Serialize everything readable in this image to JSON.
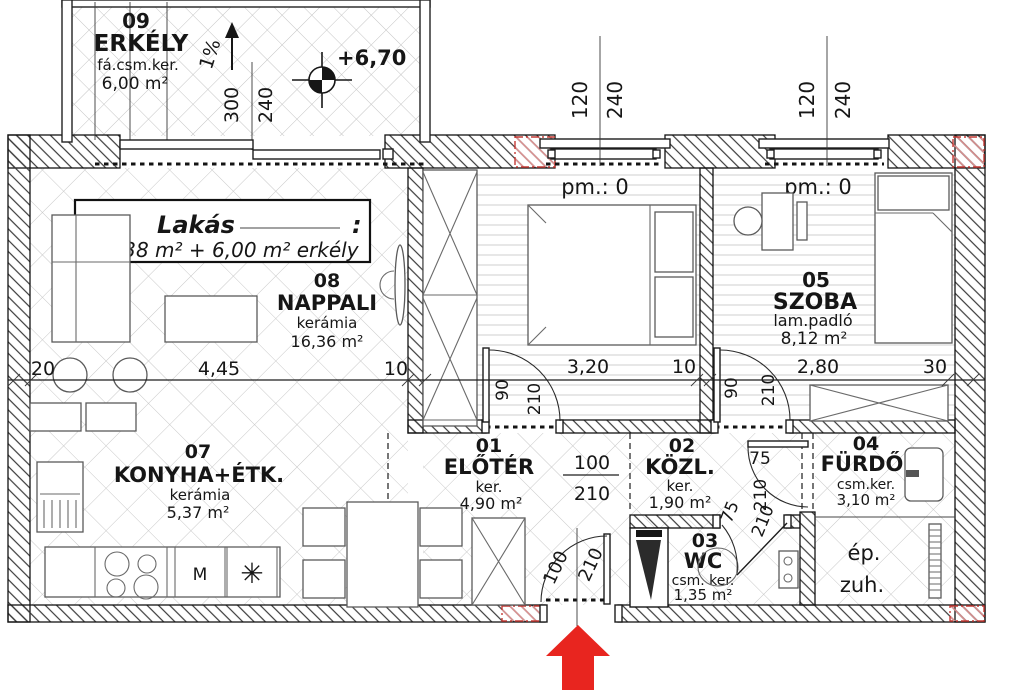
{
  "drawing": {
    "unit_label": {
      "name": "Lakás",
      "colon": ":",
      "area_line": "50,38 m² + 6,00 m² erkély"
    },
    "rooms": {
      "erkely": {
        "num": "09",
        "name": "ERKÉLY",
        "finish": "fá.csm.ker.",
        "area": "6,00 m²"
      },
      "nappali": {
        "num": "08",
        "name": "NAPPALI",
        "finish": "kerámia",
        "area": "16,36 m²"
      },
      "konyha": {
        "num": "07",
        "name": "KONYHA+ÉTK.",
        "finish": "kerámia",
        "area": "5,37 m²"
      },
      "szoba06": {
        "num": "06",
        "name": "SZOBA",
        "finish": "lam.padló",
        "area": "9,28 m²"
      },
      "szoba05": {
        "num": "05",
        "name": "SZOBA",
        "finish": "lam.padló",
        "area": "8,12 m²"
      },
      "eloter": {
        "num": "01",
        "name": "ELŐTÉR",
        "finish": "ker.",
        "area": "4,90 m²"
      },
      "kozl": {
        "num": "02",
        "name": "KÖZL.",
        "finish": "ker.",
        "area": "1,90 m²"
      },
      "wc": {
        "num": "03",
        "name": "WC",
        "finish": "csm. ker.",
        "area": "1,35 m²"
      },
      "furdo": {
        "num": "04",
        "name": "FÜRDŐ",
        "finish": "csm.ker.",
        "area": "3,10 m²"
      }
    },
    "annotations": {
      "slope": "1%",
      "level": "+6,70",
      "pm_left": "pm.: 0",
      "pm_right": "pm.: 0",
      "shower_line1": "ép.",
      "shower_line2": "zuh."
    },
    "dims": {
      "balcony_w": "300",
      "balcony_h": "240",
      "win_left_w": "120",
      "win_left_h": "240",
      "win_right_w": "120",
      "win_right_h": "240",
      "chain": [
        "20",
        "4,45",
        "10",
        "3,20",
        "10",
        "2,80",
        "30"
      ],
      "door06_w": "90",
      "door06_h": "210",
      "door05_w": "90",
      "door05_h": "210",
      "opening_w": "100",
      "opening_h": "210",
      "entry_w": "100",
      "entry_h": "210",
      "bath_w": "75",
      "bath_h": "210",
      "wc_w": "75",
      "wc_h": "210"
    },
    "symbols": {
      "washer": "M",
      "sink": "✳"
    },
    "colors": {
      "arrow_red": "#e8251f",
      "line": "#161616"
    }
  }
}
